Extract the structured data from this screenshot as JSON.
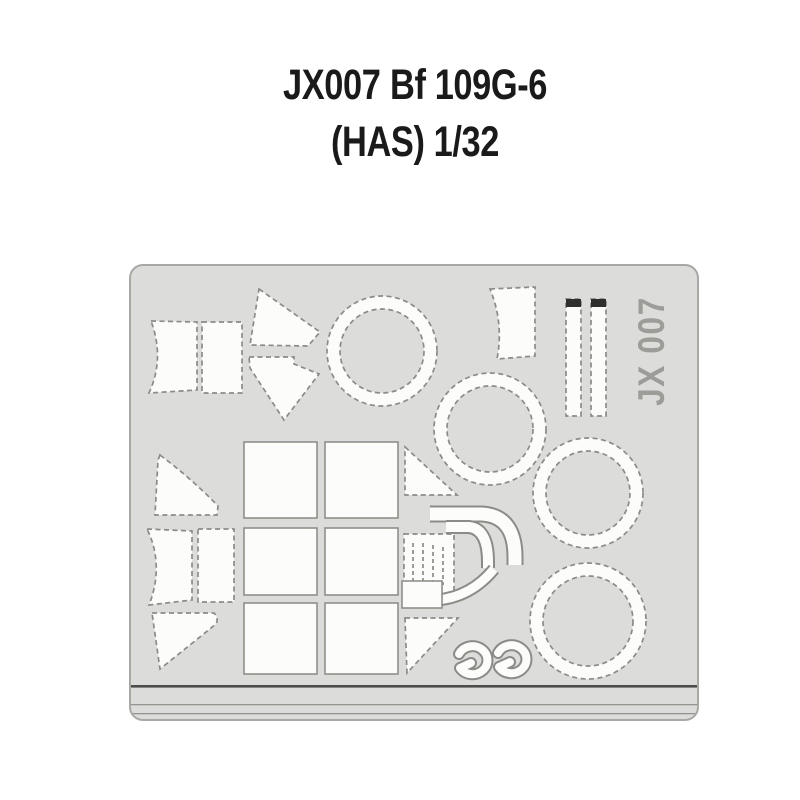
{
  "title": {
    "code": "JX007",
    "subject": "Bf 109G-6",
    "scale_line": "(HAS) 1/32"
  },
  "sheet": {
    "etched_label": "JX 007",
    "description": "die-cut canopy and wheel mask sheet",
    "colors": {
      "page_background": "#ffffff",
      "sheet_fill": "#dcdcda",
      "sheet_border": "#a8a8a4",
      "mask_fill": "#fcfcfb",
      "cut_outline": "#8b8b87",
      "film_strip_cap": "#2f2f2d",
      "etched_label_gray": "#9c9c98",
      "bottom_rule_dark": "#4c4c48",
      "bottom_rule_light": "#94948f",
      "title_text": "#1a1a1a"
    }
  }
}
